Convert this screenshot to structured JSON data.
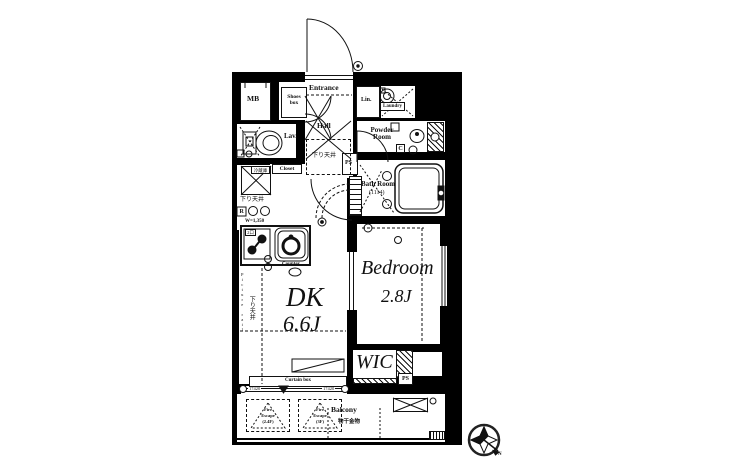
{
  "rooms": {
    "mb": "MB",
    "shoes_box": "Shoes box",
    "entrance": "Entrance",
    "hall": "Hall",
    "lin": "Lin.",
    "laundry": "Laundry",
    "powder_room": "Powder Room",
    "lav": "Lav.",
    "closet": "Closet",
    "bath_room": "Bath Room",
    "bath_size": "(1114)",
    "dk": "DK",
    "dk_size": "6.6J",
    "bedroom": "Bedroom",
    "bedroom_size": "2.8J",
    "wic": "WIC",
    "ps": "PS",
    "balcony": "Balcony"
  },
  "annotations": {
    "lowered_ceiling": "下り天井",
    "laundry_hardware": "物干金物",
    "counter": "Counter",
    "curtain_box": "Curtain box",
    "picture_rail": "Picture rail",
    "width_note": "W=1,350",
    "window_code": "17420",
    "stove_note": "2口",
    "fridge_note": "冷蔵庫",
    "marker_r": "R",
    "marker_c": "C",
    "fire_escape_line1": "Fire",
    "fire_escape_line2": "Escape",
    "fire_escape_1_floor": "(2.4F)",
    "fire_escape_2_floor": "(3F)",
    "compass_n": "N"
  },
  "colors": {
    "wall": "#000000",
    "floor": "#ffffff",
    "line": "#111111"
  }
}
